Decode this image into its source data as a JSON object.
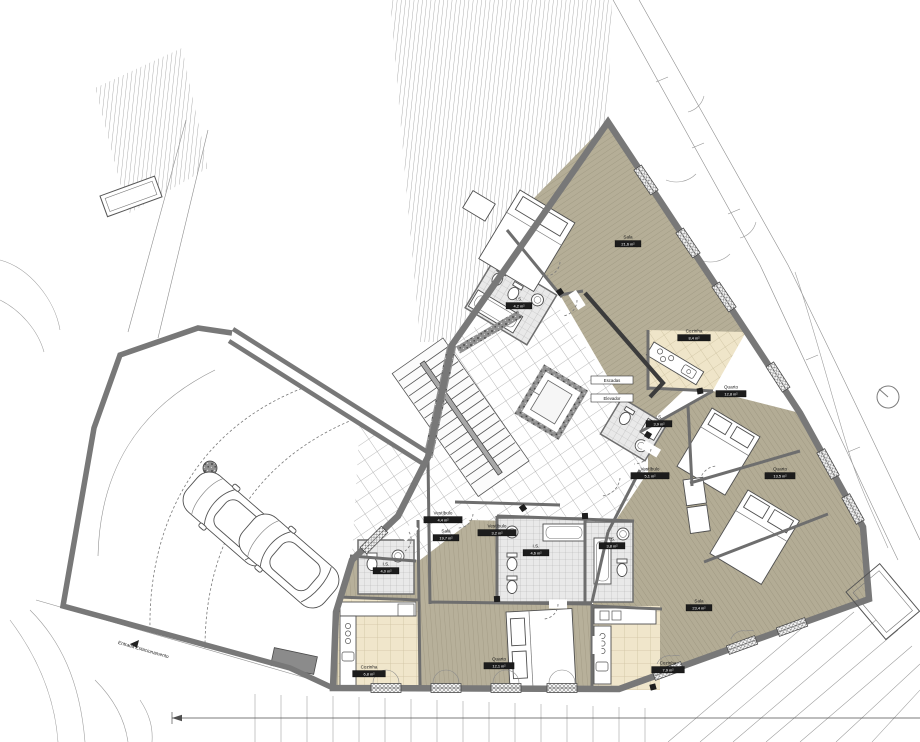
{
  "plan": {
    "site": {
      "entrance_label": "Entrada Estacionamento",
      "parking_car_count": 2
    },
    "core": {
      "stairs_label": "Escadas",
      "elevator_label": "Elevador"
    },
    "rooms": [
      {
        "name": "Sala",
        "area": "21,6 m²",
        "x": 628,
        "y": 240
      },
      {
        "name": "I.S.",
        "area": "4,2 m²",
        "x": 519,
        "y": 302
      },
      {
        "name": "Cozinha",
        "area": "8,4 m²",
        "x": 694,
        "y": 334
      },
      {
        "name": "Quarto",
        "area": "12,8 m²",
        "x": 731,
        "y": 390
      },
      {
        "name": "I.S.",
        "area": "3,9 m²",
        "x": 659,
        "y": 420
      },
      {
        "name": "Quarto",
        "area": "13,5 m²",
        "x": 780,
        "y": 472
      },
      {
        "name": "Vestíbulo",
        "area": "5,1 m²",
        "x": 650,
        "y": 472
      },
      {
        "name": "Sala",
        "area": "23,4 m²",
        "x": 699,
        "y": 604
      },
      {
        "name": "Cozinha",
        "area": "7,9 m²",
        "x": 668,
        "y": 666
      },
      {
        "name": "Quarto",
        "area": "12,1 m²",
        "x": 499,
        "y": 662
      },
      {
        "name": "I.S.",
        "area": "4,6 m²",
        "x": 536,
        "y": 549
      },
      {
        "name": "I.S.",
        "area": "3,8 m²",
        "x": 612,
        "y": 542
      },
      {
        "name": "Vestíbulo",
        "area": "4,4 m²",
        "x": 443,
        "y": 516
      },
      {
        "name": "Sala",
        "area": "19,7 m²",
        "x": 446,
        "y": 534
      },
      {
        "name": "Vestíbulo",
        "area": "3,2 m²",
        "x": 497,
        "y": 529
      },
      {
        "name": "I.S.",
        "area": "4,0 m²",
        "x": 386,
        "y": 567
      },
      {
        "name": "Cozinha",
        "area": "6,8 m²",
        "x": 369,
        "y": 670
      }
    ],
    "colors": {
      "wall": "#787878",
      "wood_floor": "#b5ae97",
      "kitchen_tile": "#efe5c9",
      "bath_tile": "#eaeaea",
      "line": "#4a4a4a"
    }
  }
}
